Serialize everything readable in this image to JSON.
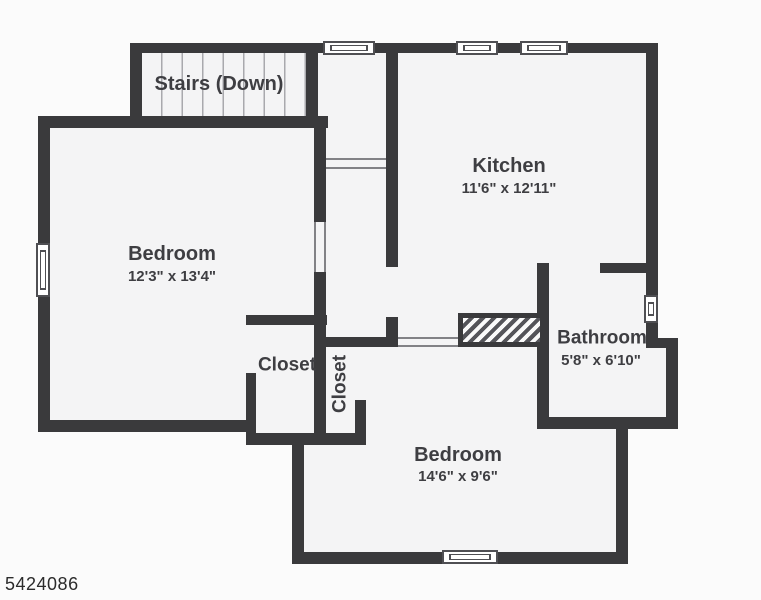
{
  "title": "Floor plan",
  "rooms": [
    {
      "id": "stairs",
      "label": "Stairs (Down)",
      "dims": ""
    },
    {
      "id": "bedroom-left",
      "label": "Bedroom",
      "dims": "12'3\" x 13'4\""
    },
    {
      "id": "kitchen",
      "label": "Kitchen",
      "dims": "11'6\" x 12'11\""
    },
    {
      "id": "closet-left",
      "label": "Closet",
      "dims": ""
    },
    {
      "id": "closet-vertical",
      "label": "Closet",
      "dims": ""
    },
    {
      "id": "bathroom",
      "label": "Bathroom",
      "dims": "5'8\" x 6'10\""
    },
    {
      "id": "bedroom-bottom",
      "label": "Bedroom",
      "dims": "14'6\" x 9'6\""
    }
  ],
  "footer": {
    "listing_id": "5424086"
  },
  "colors": {
    "wall": "#3a3a3c",
    "floor": "#f4f4f5",
    "background": "#fbfbfb",
    "label_text": "#3e3e42",
    "hatch_stripe": "#55555a"
  }
}
